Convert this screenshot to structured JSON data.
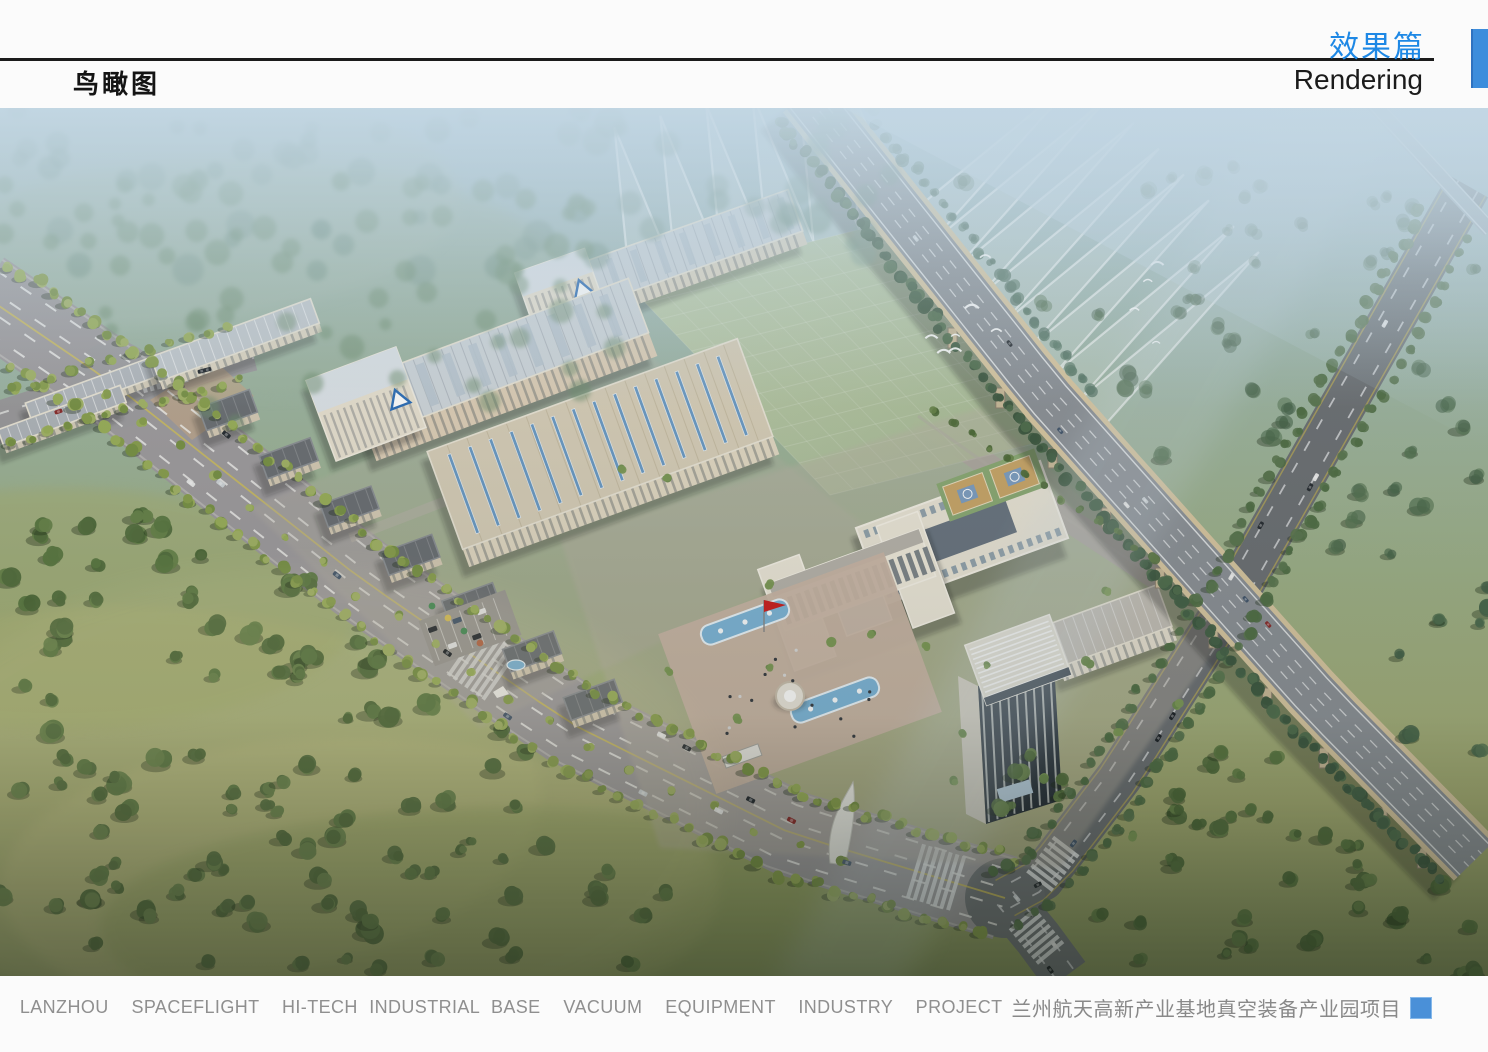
{
  "header": {
    "section_title_zh": "效果篇",
    "section_title_en": "Rendering",
    "page_title": "鸟瞰图"
  },
  "rendering": {
    "description": "Aerial bird's-eye rendering of an industrial park: long factory workshops with blue-striped roofs, a green glass test field, white office buildings with fountain plaza and red flag, a high-rise tower, tree-lined boulevard, elevated highway viaduct crossing diagonally, misty forests and meadows"
  },
  "footer": {
    "caption_en": "LANZHOU  SPACEFLIGHT  HI-TECH INDUSTRIAL BASE  VACUUM  EQUIPMENT  INDUSTRY  PROJECT",
    "caption_zh": "兰州航天高新产业基地真空装备产业园项目"
  },
  "colors": {
    "accent_blue": "#1e88e5",
    "header_bar_blue": "#3d8ddc",
    "caption_square_blue": "#4a90d8",
    "caption_gray": "#8f8f8f",
    "line_black": "#1b1b1b"
  }
}
